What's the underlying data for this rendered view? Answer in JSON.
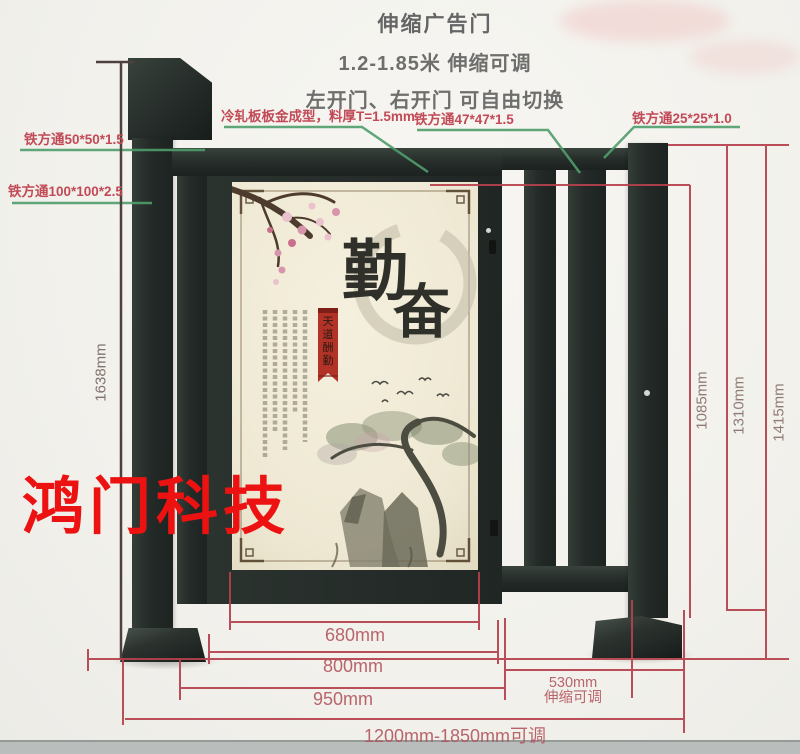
{
  "header": {
    "title": "伸缩广告门",
    "subtitle1": "1.2-1.85米 伸缩可调",
    "subtitle2": "左开门、右开门 可自由切换"
  },
  "labels": {
    "tube_50": "铁方通50*50*1.5",
    "tube_100": "铁方通100*100*2.5",
    "cold_rolled_panel": "冷轧板板金成型，料厚T=1.5mm",
    "tube_47": "铁方通47*47*1.5",
    "tube_25": "铁方通25*25*1.0"
  },
  "dimensions": {
    "post_height": "1638mm",
    "fence_height": "1085mm",
    "mid_height": "1310mm",
    "outer_height": "1415mm",
    "panel_width": "680mm",
    "gate_width": "800mm",
    "gate_outer_width": "950mm",
    "telescopic_width": "530mm",
    "telescopic_note": "伸缩可调",
    "total_width_range": "1200mm-1850mm可调"
  },
  "watermark": "鸿门科技",
  "artwork": {
    "char_top": "勤",
    "char_bottom": "奋",
    "seal_chars": [
      "天",
      "道",
      "酬",
      "勤"
    ]
  },
  "colors": {
    "accent_red": "#b5414d",
    "leader_green": "#4f9d6b",
    "metal_dark": "#232a27",
    "watermark_red": "#ec1212",
    "panel_cream": "#efe9d6"
  }
}
